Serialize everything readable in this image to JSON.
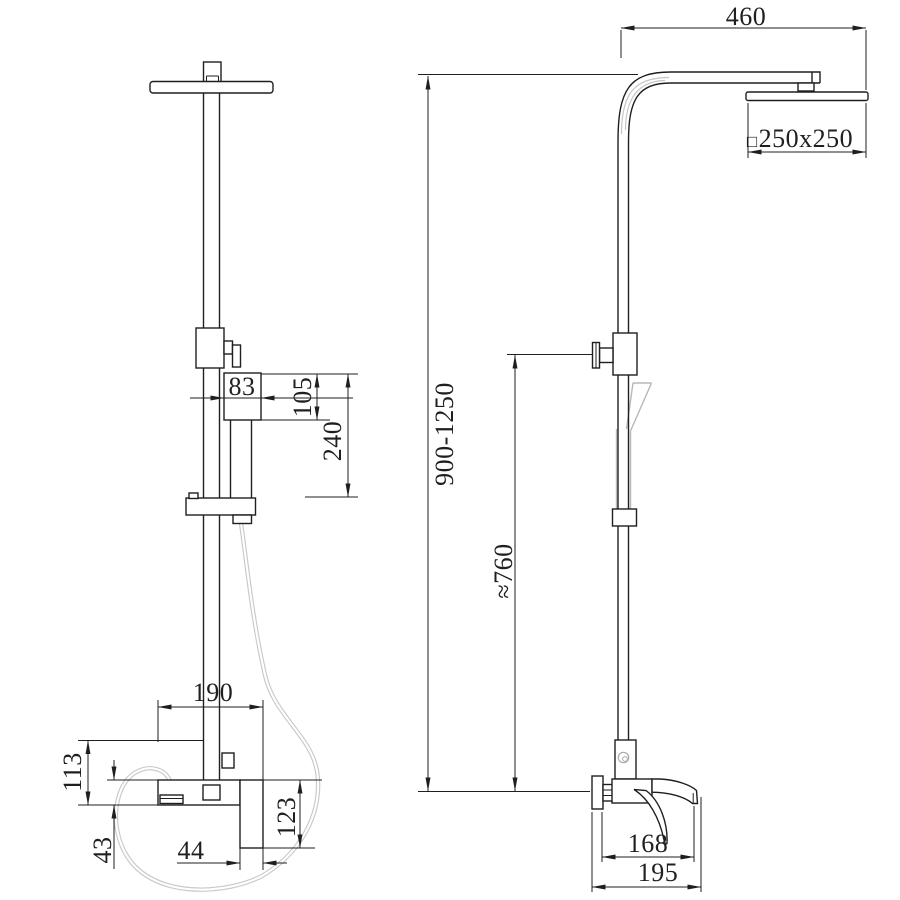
{
  "drawing": {
    "background": "#ffffff",
    "line_color": "#1f1f1f",
    "hose_color": "#c9c9c9",
    "highlight_color": "#c5c5c5",
    "dimensions": {
      "holder_width": {
        "label": "83"
      },
      "holder_height": {
        "label": "105"
      },
      "holder_to_bar": {
        "label": "240"
      },
      "mixer_width": {
        "label": "190"
      },
      "mixer_height": {
        "label": "113"
      },
      "body_height": {
        "label": "43"
      },
      "handle_width": {
        "label": "44"
      },
      "handle_drop": {
        "label": "123"
      },
      "arm_reach": {
        "label": "460"
      },
      "head_size": {
        "prefix": "□",
        "label": "250x250"
      },
      "column_height": {
        "label": "900-1250"
      },
      "install_height": {
        "label": "≈760"
      },
      "spout_reach": {
        "label": "168"
      },
      "total_depth": {
        "label": "195"
      }
    }
  }
}
